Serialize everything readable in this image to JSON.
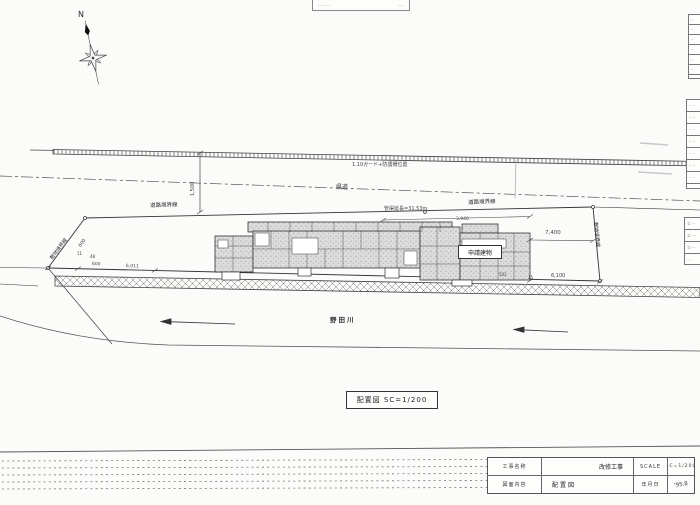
{
  "colors": {
    "paper": "#fbfbfa",
    "ink": "#333333",
    "building_shade": "#dcdcdc"
  },
  "drawing": {
    "n_label": "N",
    "top_box": {
      "left": "··········",
      "right": "·····"
    },
    "fence_label": "1.10ガード+防護柵位置",
    "road_center_label": "県道",
    "dim_1500": "1,500",
    "road_boundary_left": "道路境界線",
    "road_boundary_right": "道路境界線",
    "site_boundary_left": "敷地境界線",
    "site_boundary_right": "敷地境界線",
    "dim_600_left": "600",
    "pipe_length_label": "管渠延長=31.53m",
    "dim_3940": "3,940",
    "building_box_label": "申請建物",
    "dim_7400": "7,400",
    "dim_6100": "6,100",
    "dim_600_bottom": "600",
    "dim_6011": "6,011",
    "dim_11": "11",
    "dim_48": "48",
    "dim_502": "502",
    "dim_15": "15",
    "river_label": "野田川",
    "caption": "配置図 SC=1/200"
  },
  "right_tables": {
    "a": {
      "rows": [
        "··",
        "··",
        "··",
        "··",
        "··",
        "··",
        "··"
      ]
    },
    "b": {
      "rows": [
        "·· ·",
        "·· ··",
        "·· ·",
        "·· ··",
        "·· ·",
        "·· ··",
        "·· ·",
        "··"
      ]
    },
    "c": {
      "rows": [
        "① ···",
        "② ···",
        "③ ···",
        "···"
      ]
    }
  },
  "title_block": {
    "project_label": "工事名称",
    "project_value": "改修工事",
    "scale_label": "SCALE",
    "scale_value": "SC=1/200",
    "sheet_label": "図面内容",
    "sheet_value": "配置図",
    "date_label": "年月日",
    "date_value": "'95.8"
  }
}
